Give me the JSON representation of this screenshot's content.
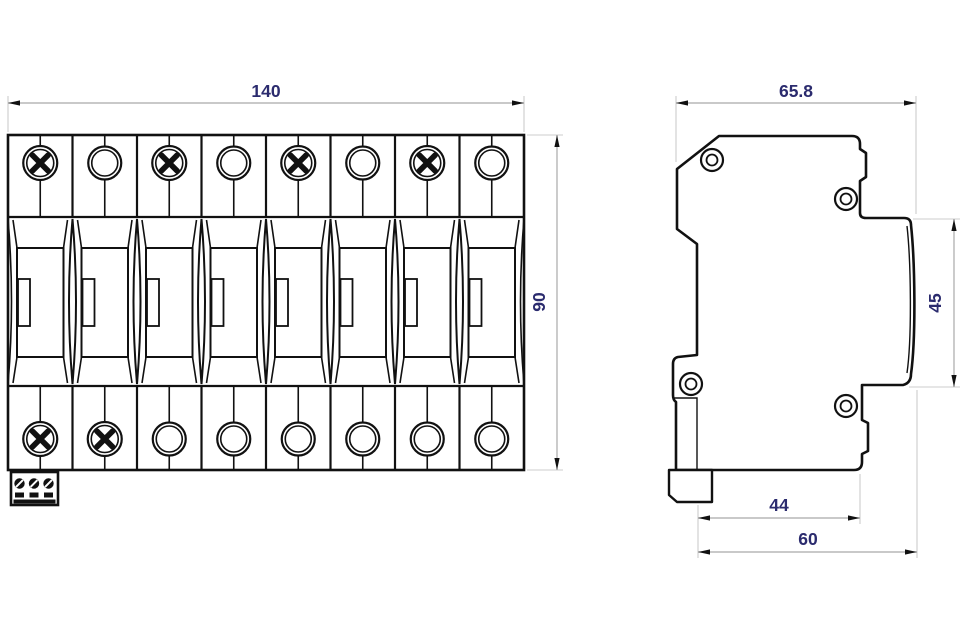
{
  "drawing": {
    "title": "surge-protective-device-outline-drawing",
    "colors": {
      "background": "#ffffff",
      "outline": "#111111",
      "dimension_line": "#a9a9a9",
      "extension_line": "#cccccc",
      "dimension_label": "#2b2b6e"
    },
    "front_view": {
      "module_count": 8,
      "top_row_screw_modules": [
        1,
        3,
        5,
        7
      ],
      "bottom_row_screw_modules": [
        1,
        2
      ],
      "dims": {
        "width": "140",
        "height": "90"
      }
    },
    "side_view": {
      "dims": {
        "total_width": "65.8",
        "front_block_height": "45",
        "depth_to_step": "44",
        "total_depth": "60"
      }
    }
  }
}
